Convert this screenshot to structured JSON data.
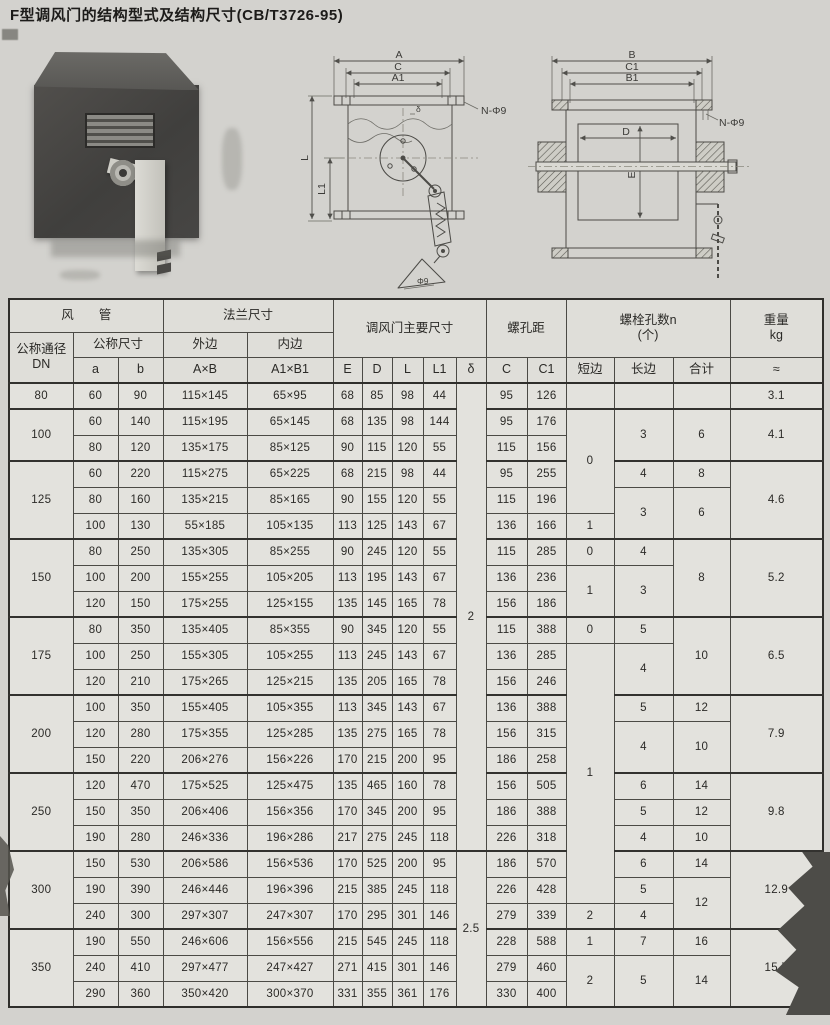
{
  "title": "F型调风门的结构型式及结构尺寸(CB/T3726-95)",
  "figures": {
    "front_view": {
      "dim_a": "A",
      "dim_c": "C",
      "dim_a1": "A1",
      "holes": "N-Φ9",
      "dim_l": "L",
      "dim_l1": "L1",
      "dim_delta": "δ",
      "dim_phi9": "Φ9"
    },
    "side_view": {
      "dim_b": "B",
      "dim_c1": "C1",
      "dim_b1": "B1",
      "holes": "N-Φ9",
      "dim_d": "D",
      "dim_e": "E"
    }
  },
  "table": {
    "header_rows": [
      [
        {
          "t": "风　　管",
          "c": 3
        },
        {
          "t": "法兰尺寸",
          "c": 2
        },
        {
          "t": "调风门主要尺寸",
          "c": 5,
          "r": 2
        },
        {
          "t": "螺孔距",
          "c": 2,
          "r": 2
        },
        {
          "t": "螺栓孔数n\n(个)",
          "c": 3,
          "r": 2
        },
        {
          "t": "重量\nkg",
          "r": 2
        }
      ],
      [
        {
          "t": "公称通径\nDN",
          "r": 2
        },
        {
          "t": "公称尺寸",
          "c": 2
        },
        {
          "t": "外边"
        },
        {
          "t": "内边"
        }
      ],
      [
        {
          "t": "a"
        },
        {
          "t": "b"
        },
        {
          "t": "A×B"
        },
        {
          "t": "A1×B1"
        },
        {
          "t": "E"
        },
        {
          "t": "D"
        },
        {
          "t": "L"
        },
        {
          "t": "L1"
        },
        {
          "t": "δ"
        },
        {
          "t": "C"
        },
        {
          "t": "C1"
        },
        {
          "t": "短边"
        },
        {
          "t": "长边"
        },
        {
          "t": "合计"
        },
        {
          "t": "≈"
        }
      ]
    ],
    "group_starts": [
      0,
      1,
      3,
      6,
      9,
      12,
      15,
      18,
      21
    ],
    "rows": [
      [
        {
          "t": "80"
        },
        {
          "t": "60"
        },
        {
          "t": "90"
        },
        {
          "t": "115×145"
        },
        {
          "t": "65×95"
        },
        {
          "t": "68"
        },
        {
          "t": "85"
        },
        {
          "t": "98"
        },
        {
          "t": "44"
        },
        {
          "t": "2",
          "r": 18
        },
        {
          "t": "95"
        },
        {
          "t": "126"
        },
        {
          "t": ""
        },
        {
          "t": ""
        },
        {
          "t": ""
        },
        {
          "t": "3.1"
        }
      ],
      [
        {
          "t": "100",
          "r": 2
        },
        {
          "t": "60"
        },
        {
          "t": "140"
        },
        {
          "t": "115×195"
        },
        {
          "t": "65×145"
        },
        {
          "t": "68"
        },
        {
          "t": "135"
        },
        {
          "t": "98"
        },
        {
          "t": "144"
        },
        {
          "t": "95"
        },
        {
          "t": "176"
        },
        {
          "t": "0",
          "r": 4
        },
        {
          "t": "3",
          "r": 2
        },
        {
          "t": "6",
          "r": 2
        },
        {
          "t": "4.1",
          "r": 2
        }
      ],
      [
        {
          "t": "80"
        },
        {
          "t": "120"
        },
        {
          "t": "135×175"
        },
        {
          "t": "85×125"
        },
        {
          "t": "90"
        },
        {
          "t": "115"
        },
        {
          "t": "120"
        },
        {
          "t": "55"
        },
        {
          "t": "115"
        },
        {
          "t": "156"
        }
      ],
      [
        {
          "t": "125",
          "r": 3
        },
        {
          "t": "60"
        },
        {
          "t": "220"
        },
        {
          "t": "115×275"
        },
        {
          "t": "65×225"
        },
        {
          "t": "68"
        },
        {
          "t": "215"
        },
        {
          "t": "98"
        },
        {
          "t": "44"
        },
        {
          "t": "95"
        },
        {
          "t": "255"
        },
        {
          "t": "4"
        },
        {
          "t": "8"
        },
        {
          "t": "4.6",
          "r": 3
        }
      ],
      [
        {
          "t": "80"
        },
        {
          "t": "160"
        },
        {
          "t": "135×215"
        },
        {
          "t": "85×165"
        },
        {
          "t": "90"
        },
        {
          "t": "155"
        },
        {
          "t": "120"
        },
        {
          "t": "55"
        },
        {
          "t": "115"
        },
        {
          "t": "196"
        },
        {
          "t": "3",
          "r": 2
        },
        {
          "t": "6",
          "r": 2
        }
      ],
      [
        {
          "t": "100"
        },
        {
          "t": "130"
        },
        {
          "t": "55×185"
        },
        {
          "t": "105×135"
        },
        {
          "t": "113"
        },
        {
          "t": "125"
        },
        {
          "t": "143"
        },
        {
          "t": "67"
        },
        {
          "t": "136"
        },
        {
          "t": "166"
        },
        {
          "t": "1"
        }
      ],
      [
        {
          "t": "150",
          "r": 3
        },
        {
          "t": "80"
        },
        {
          "t": "250"
        },
        {
          "t": "135×305"
        },
        {
          "t": "85×255"
        },
        {
          "t": "90"
        },
        {
          "t": "245"
        },
        {
          "t": "120"
        },
        {
          "t": "55"
        },
        {
          "t": "115"
        },
        {
          "t": "285"
        },
        {
          "t": "0"
        },
        {
          "t": "4"
        },
        {
          "t": "8",
          "r": 3
        },
        {
          "t": "5.2",
          "r": 3
        }
      ],
      [
        {
          "t": "100"
        },
        {
          "t": "200"
        },
        {
          "t": "155×255"
        },
        {
          "t": "105×205"
        },
        {
          "t": "113"
        },
        {
          "t": "195"
        },
        {
          "t": "143"
        },
        {
          "t": "67"
        },
        {
          "t": "136"
        },
        {
          "t": "236"
        },
        {
          "t": "1",
          "r": 2
        },
        {
          "t": "3",
          "r": 2
        }
      ],
      [
        {
          "t": "120"
        },
        {
          "t": "150"
        },
        {
          "t": "175×255"
        },
        {
          "t": "125×155"
        },
        {
          "t": "135"
        },
        {
          "t": "145"
        },
        {
          "t": "165"
        },
        {
          "t": "78"
        },
        {
          "t": "156"
        },
        {
          "t": "186"
        }
      ],
      [
        {
          "t": "175",
          "r": 3
        },
        {
          "t": "80"
        },
        {
          "t": "350"
        },
        {
          "t": "135×405"
        },
        {
          "t": "85×355"
        },
        {
          "t": "90"
        },
        {
          "t": "345"
        },
        {
          "t": "120"
        },
        {
          "t": "55"
        },
        {
          "t": "115"
        },
        {
          "t": "388"
        },
        {
          "t": "0"
        },
        {
          "t": "5"
        },
        {
          "t": "10",
          "r": 3
        },
        {
          "t": "6.5",
          "r": 3
        }
      ],
      [
        {
          "t": "100"
        },
        {
          "t": "250"
        },
        {
          "t": "155×305"
        },
        {
          "t": "105×255"
        },
        {
          "t": "113"
        },
        {
          "t": "245"
        },
        {
          "t": "143"
        },
        {
          "t": "67"
        },
        {
          "t": "136"
        },
        {
          "t": "285"
        },
        {
          "t": "1",
          "r": 10
        },
        {
          "t": "4",
          "r": 2
        }
      ],
      [
        {
          "t": "120"
        },
        {
          "t": "210"
        },
        {
          "t": "175×265"
        },
        {
          "t": "125×215"
        },
        {
          "t": "135"
        },
        {
          "t": "205"
        },
        {
          "t": "165"
        },
        {
          "t": "78"
        },
        {
          "t": "156"
        },
        {
          "t": "246"
        }
      ],
      [
        {
          "t": "200",
          "r": 3
        },
        {
          "t": "100"
        },
        {
          "t": "350"
        },
        {
          "t": "155×405"
        },
        {
          "t": "105×355"
        },
        {
          "t": "113"
        },
        {
          "t": "345"
        },
        {
          "t": "143"
        },
        {
          "t": "67"
        },
        {
          "t": "136"
        },
        {
          "t": "388"
        },
        {
          "t": "5"
        },
        {
          "t": "12"
        },
        {
          "t": "7.9",
          "r": 3
        }
      ],
      [
        {
          "t": "120"
        },
        {
          "t": "280"
        },
        {
          "t": "175×355"
        },
        {
          "t": "125×285"
        },
        {
          "t": "135"
        },
        {
          "t": "275"
        },
        {
          "t": "165"
        },
        {
          "t": "78"
        },
        {
          "t": "156"
        },
        {
          "t": "315"
        },
        {
          "t": "4",
          "r": 2
        },
        {
          "t": "10",
          "r": 2
        }
      ],
      [
        {
          "t": "150"
        },
        {
          "t": "220"
        },
        {
          "t": "206×276"
        },
        {
          "t": "156×226"
        },
        {
          "t": "170"
        },
        {
          "t": "215"
        },
        {
          "t": "200"
        },
        {
          "t": "95"
        },
        {
          "t": "186"
        },
        {
          "t": "258"
        }
      ],
      [
        {
          "t": "250",
          "r": 3
        },
        {
          "t": "120"
        },
        {
          "t": "470"
        },
        {
          "t": "175×525"
        },
        {
          "t": "125×475"
        },
        {
          "t": "135"
        },
        {
          "t": "465"
        },
        {
          "t": "160"
        },
        {
          "t": "78"
        },
        {
          "t": "156"
        },
        {
          "t": "505"
        },
        {
          "t": "6"
        },
        {
          "t": "14"
        },
        {
          "t": "9.8",
          "r": 3
        }
      ],
      [
        {
          "t": "150"
        },
        {
          "t": "350"
        },
        {
          "t": "206×406"
        },
        {
          "t": "156×356"
        },
        {
          "t": "170"
        },
        {
          "t": "345"
        },
        {
          "t": "200"
        },
        {
          "t": "95"
        },
        {
          "t": "186"
        },
        {
          "t": "388"
        },
        {
          "t": "5"
        },
        {
          "t": "12"
        }
      ],
      [
        {
          "t": "190"
        },
        {
          "t": "280"
        },
        {
          "t": "246×336"
        },
        {
          "t": "196×286"
        },
        {
          "t": "217"
        },
        {
          "t": "275"
        },
        {
          "t": "245"
        },
        {
          "t": "118"
        },
        {
          "t": "226"
        },
        {
          "t": "318"
        },
        {
          "t": "4"
        },
        {
          "t": "10"
        }
      ],
      [
        {
          "t": "300",
          "r": 3
        },
        {
          "t": "150"
        },
        {
          "t": "530"
        },
        {
          "t": "206×586"
        },
        {
          "t": "156×536"
        },
        {
          "t": "170"
        },
        {
          "t": "525"
        },
        {
          "t": "200"
        },
        {
          "t": "95"
        },
        {
          "t": "2.5",
          "r": 6
        },
        {
          "t": "186"
        },
        {
          "t": "570"
        },
        {
          "t": "6"
        },
        {
          "t": "14"
        },
        {
          "t": "12.9",
          "r": 3
        }
      ],
      [
        {
          "t": "190"
        },
        {
          "t": "390"
        },
        {
          "t": "246×446"
        },
        {
          "t": "196×396"
        },
        {
          "t": "215"
        },
        {
          "t": "385"
        },
        {
          "t": "245"
        },
        {
          "t": "118"
        },
        {
          "t": "226"
        },
        {
          "t": "428"
        },
        {
          "t": "5"
        },
        {
          "t": "12",
          "r": 2
        }
      ],
      [
        {
          "t": "240"
        },
        {
          "t": "300"
        },
        {
          "t": "297×307"
        },
        {
          "t": "247×307"
        },
        {
          "t": "170"
        },
        {
          "t": "295"
        },
        {
          "t": "301"
        },
        {
          "t": "146"
        },
        {
          "t": "279"
        },
        {
          "t": "339"
        },
        {
          "t": "2"
        },
        {
          "t": "4"
        }
      ],
      [
        {
          "t": "350",
          "r": 3
        },
        {
          "t": "190"
        },
        {
          "t": "550"
        },
        {
          "t": "246×606"
        },
        {
          "t": "156×556"
        },
        {
          "t": "215"
        },
        {
          "t": "545"
        },
        {
          "t": "245"
        },
        {
          "t": "118"
        },
        {
          "t": "228"
        },
        {
          "t": "588"
        },
        {
          "t": "1"
        },
        {
          "t": "7"
        },
        {
          "t": "16"
        },
        {
          "t": "15.7",
          "r": 3
        }
      ],
      [
        {
          "t": "240"
        },
        {
          "t": "410"
        },
        {
          "t": "297×477"
        },
        {
          "t": "247×427"
        },
        {
          "t": "271"
        },
        {
          "t": "415"
        },
        {
          "t": "301"
        },
        {
          "t": "146"
        },
        {
          "t": "279"
        },
        {
          "t": "460"
        },
        {
          "t": "2",
          "r": 2
        },
        {
          "t": "5",
          "r": 2
        },
        {
          "t": "14",
          "r": 2
        }
      ],
      [
        {
          "t": "290"
        },
        {
          "t": "360"
        },
        {
          "t": "350×420"
        },
        {
          "t": "300×370"
        },
        {
          "t": "331"
        },
        {
          "t": "355"
        },
        {
          "t": "361"
        },
        {
          "t": "176"
        },
        {
          "t": "330"
        },
        {
          "t": "400"
        }
      ]
    ]
  },
  "colors": {
    "paper": "#d3d2ce",
    "cell": "#e3e2dd",
    "line": "#4b4a45",
    "ink": "#2b2a27"
  }
}
